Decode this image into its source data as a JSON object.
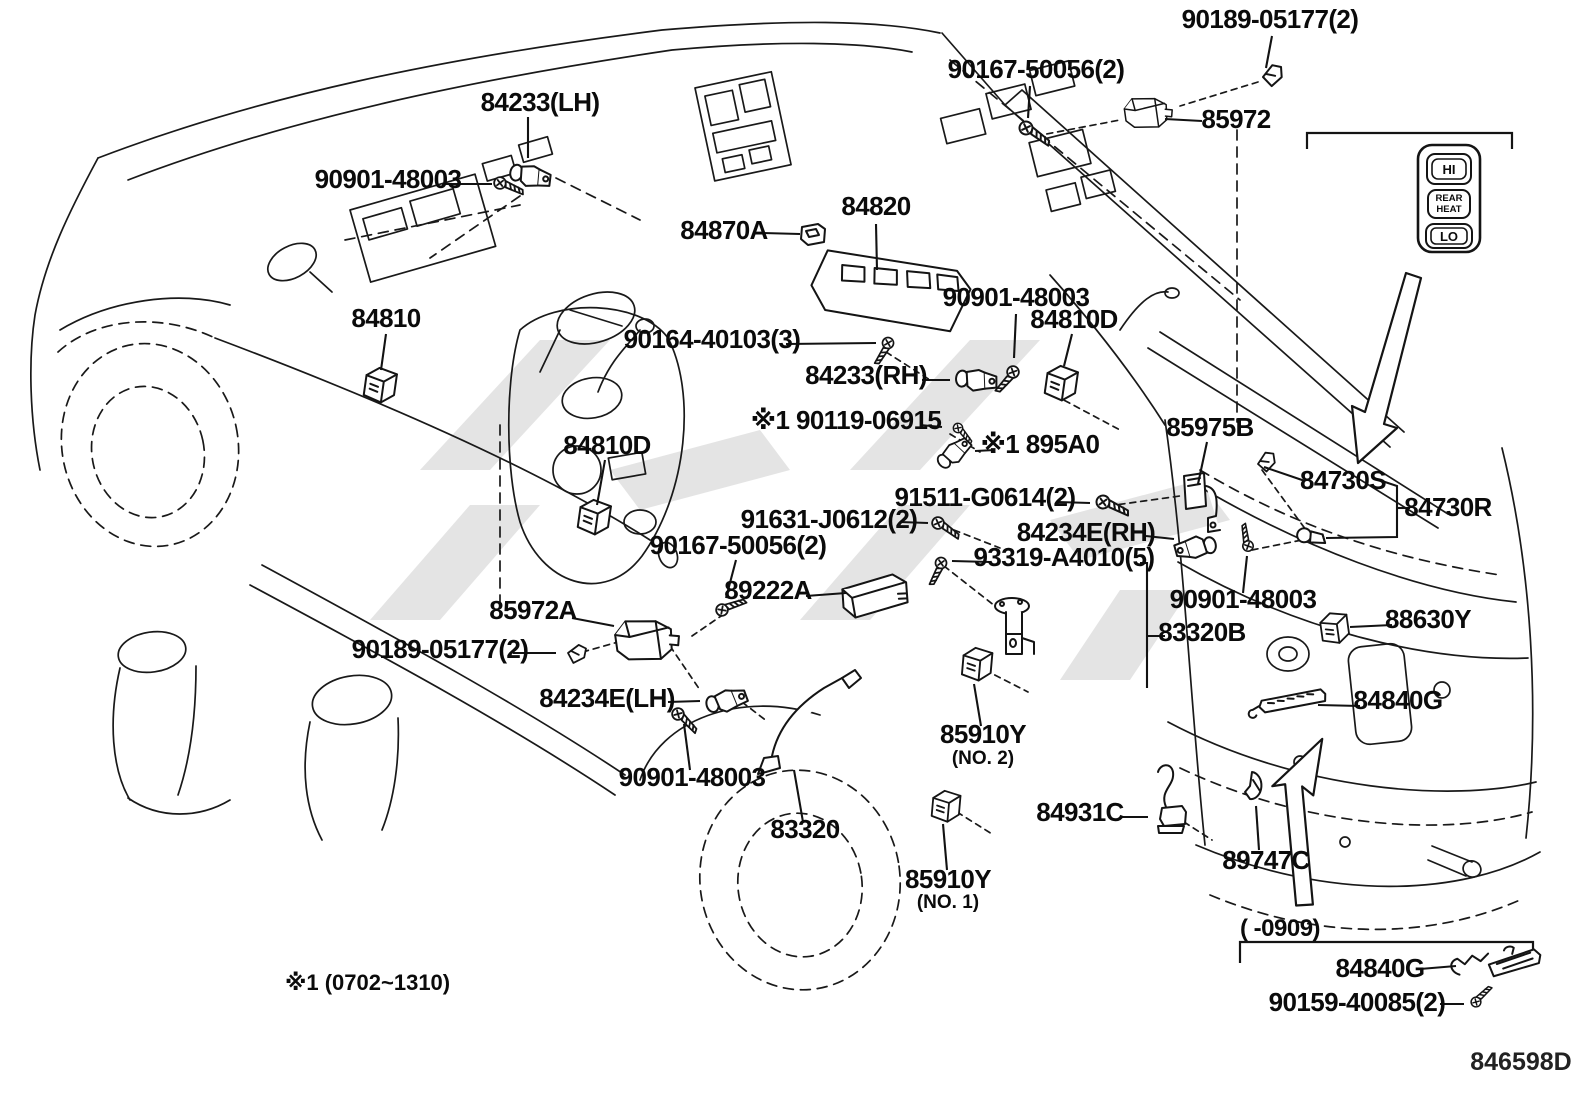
{
  "diagram_code": "846598D",
  "footnote": "※1 (0702~1310)",
  "bottom_inset": {
    "caption": "(    -0909)"
  },
  "inset_switch": {
    "hi": "HI",
    "rear": "REAR",
    "heat": "HEAT",
    "lo": "LO"
  },
  "colors": {
    "ink": "#141414",
    "paper": "#ffffff",
    "watermark": "#c9c9c9"
  },
  "labels": [
    {
      "text": "90189-05177(2)",
      "x": 1270,
      "y": 28,
      "leader": [
        [
          1272,
          36
        ],
        [
          1266,
          68
        ]
      ]
    },
    {
      "text": "90167-50056(2)",
      "x": 1036,
      "y": 78,
      "leader": [
        [
          1030,
          86
        ],
        [
          1028,
          118
        ]
      ]
    },
    {
      "text": "85972",
      "x": 1236,
      "y": 128,
      "leader": [
        [
          1202,
          121
        ],
        [
          1165,
          119
        ]
      ]
    },
    {
      "text": "84233(LH)",
      "x": 540,
      "y": 111,
      "leader": [
        [
          528,
          117
        ],
        [
          528,
          158
        ]
      ]
    },
    {
      "text": "90901-48003",
      "x": 388,
      "y": 188,
      "leader": [
        [
          442,
          184
        ],
        [
          492,
          184
        ]
      ]
    },
    {
      "text": "84870A",
      "x": 724,
      "y": 239,
      "leader": [
        [
          763,
          233
        ],
        [
          800,
          234
        ]
      ]
    },
    {
      "text": "84820",
      "x": 876,
      "y": 215,
      "leader": [
        [
          876,
          224
        ],
        [
          877,
          270
        ]
      ]
    },
    {
      "text": "90164-40103(3)",
      "x": 712,
      "y": 348,
      "leader": [
        [
          786,
          344
        ],
        [
          876,
          343
        ]
      ]
    },
    {
      "text": "84810",
      "x": 386,
      "y": 327,
      "leader": [
        [
          386,
          334
        ],
        [
          381,
          370
        ]
      ]
    },
    {
      "text": "84233(RH)",
      "x": 866,
      "y": 384,
      "leader": [
        [
          922,
          380
        ],
        [
          950,
          380
        ]
      ]
    },
    {
      "text": "90901-48003",
      "x": 1016,
      "y": 306,
      "leader": [
        [
          1016,
          314
        ],
        [
          1014,
          358
        ]
      ]
    },
    {
      "text": "84810D",
      "x": 1074,
      "y": 328,
      "leader": [
        [
          1072,
          334
        ],
        [
          1064,
          366
        ]
      ]
    },
    {
      "text": "※1 90119-06915",
      "x": 846,
      "y": 429,
      "leader": [
        [
          920,
          425
        ],
        [
          942,
          427
        ]
      ]
    },
    {
      "text": "※1 895A0",
      "x": 1040,
      "y": 453,
      "leader": [
        [
          995,
          450
        ],
        [
          975,
          451
        ]
      ]
    },
    {
      "text": "91511-G0614(2)",
      "x": 985,
      "y": 506,
      "leader": [
        [
          1058,
          502
        ],
        [
          1090,
          503
        ]
      ]
    },
    {
      "text": "91631-J0612(2)",
      "x": 829,
      "y": 528,
      "leader": [
        [
          900,
          522
        ],
        [
          928,
          523
        ]
      ]
    },
    {
      "text": "84234E(RH)",
      "x": 1086,
      "y": 541,
      "leader": [
        [
          1146,
          536
        ],
        [
          1174,
          539
        ]
      ]
    },
    {
      "text": "93319-A4010(5)",
      "x": 1064,
      "y": 566,
      "leader": [
        [
          990,
          562
        ],
        [
          952,
          561
        ]
      ],
      "leader2": [
        [
          1140,
          563
        ],
        [
          1147,
          563
        ],
        [
          1147,
          688
        ]
      ]
    },
    {
      "text": "83320B",
      "x": 1202,
      "y": 641,
      "leader": [
        [
          1165,
          636
        ],
        [
          1148,
          636
        ]
      ]
    },
    {
      "text": "85975B",
      "x": 1210,
      "y": 436,
      "leader": [
        [
          1207,
          442
        ],
        [
          1198,
          484
        ]
      ]
    },
    {
      "text": "84730S",
      "x": 1343,
      "y": 489,
      "leader": [
        [
          1305,
          481
        ],
        [
          1264,
          467
        ]
      ],
      "leader2": [
        [
          1382,
          481
        ],
        [
          1397,
          486
        ],
        [
          1397,
          537
        ],
        [
          1326,
          538
        ]
      ]
    },
    {
      "text": "84730R",
      "x": 1448,
      "y": 516,
      "leader": [
        [
          1410,
          508
        ],
        [
          1397,
          508
        ]
      ]
    },
    {
      "text": "90901-48003",
      "x": 1243,
      "y": 608,
      "leader": [
        [
          1243,
          593
        ],
        [
          1247,
          556
        ]
      ]
    },
    {
      "text": "88630Y",
      "x": 1428,
      "y": 628,
      "leader": [
        [
          1392,
          625
        ],
        [
          1350,
          627
        ]
      ]
    },
    {
      "text": "84840G",
      "x": 1398,
      "y": 709,
      "leader": [
        [
          1360,
          706
        ],
        [
          1318,
          705
        ]
      ]
    },
    {
      "text": "85910Y",
      "x": 983,
      "y": 743,
      "sub": "(NO. 2)",
      "suby": 764,
      "leader": [
        [
          981,
          726
        ],
        [
          974,
          684
        ]
      ]
    },
    {
      "text": "84931C",
      "x": 1080,
      "y": 821,
      "leader": [
        [
          1120,
          817
        ],
        [
          1148,
          817
        ]
      ]
    },
    {
      "text": "89747C",
      "x": 1266,
      "y": 869,
      "leader": [
        [
          1259,
          850
        ],
        [
          1256,
          806
        ]
      ]
    },
    {
      "text": "85910Y",
      "x": 948,
      "y": 888,
      "sub": "(NO. 1)",
      "suby": 908,
      "leader": [
        [
          947,
          870
        ],
        [
          943,
          824
        ]
      ]
    },
    {
      "text": "83320",
      "x": 805,
      "y": 838,
      "leader": [
        [
          803,
          822
        ],
        [
          794,
          770
        ]
      ]
    },
    {
      "text": "90901-48003",
      "x": 692,
      "y": 786,
      "leader": [
        [
          690,
          770
        ],
        [
          684,
          724
        ]
      ]
    },
    {
      "text": "84234E(LH)",
      "x": 607,
      "y": 707,
      "leader": [
        [
          668,
          702
        ],
        [
          700,
          701
        ]
      ]
    },
    {
      "text": "90189-05177(2)",
      "x": 440,
      "y": 658,
      "leader": [
        [
          513,
          653
        ],
        [
          556,
          653
        ]
      ]
    },
    {
      "text": "90167-50056(2)",
      "x": 738,
      "y": 554,
      "leader": [
        [
          736,
          560
        ],
        [
          726,
          598
        ]
      ]
    },
    {
      "text": "85972A",
      "x": 533,
      "y": 619,
      "leader": [
        [
          572,
          618
        ],
        [
          614,
          626
        ]
      ]
    },
    {
      "text": "89222A",
      "x": 768,
      "y": 599,
      "leader": [
        [
          806,
          596
        ],
        [
          846,
          593
        ]
      ]
    },
    {
      "text": "84810D",
      "x": 607,
      "y": 454,
      "leader": [
        [
          605,
          460
        ],
        [
          597,
          505
        ]
      ]
    },
    {
      "text": "84840G",
      "x": 1380,
      "y": 977,
      "leader": [
        [
          1420,
          969
        ],
        [
          1456,
          966
        ]
      ]
    },
    {
      "text": "90159-40085(2)",
      "x": 1357,
      "y": 1011,
      "leader": [
        [
          1440,
          1004
        ],
        [
          1464,
          1004
        ]
      ]
    }
  ],
  "parts": [
    {
      "type": "clip",
      "x": 1263,
      "y": 77,
      "rot": -15
    },
    {
      "type": "screw",
      "x": 1026,
      "y": 128,
      "rot": 20
    },
    {
      "type": "actuator",
      "x": 1146,
      "y": 112,
      "rot": -8,
      "scale": 0.75
    },
    {
      "type": "sensor",
      "x": 532,
      "y": 176,
      "rot": 12
    },
    {
      "type": "screw",
      "x": 500,
      "y": 183,
      "rot": 8,
      "scale": 0.9
    },
    {
      "type": "sswitch",
      "x": 812,
      "y": 235,
      "rot": 0
    },
    {
      "type": "mswitch",
      "x": 890,
      "y": 287,
      "rot": 16
    },
    {
      "type": "screw",
      "x": 888,
      "y": 343,
      "rot": 105,
      "scale": 0.85
    },
    {
      "type": "relay",
      "x": 379,
      "y": 387,
      "rot": 8
    },
    {
      "type": "sensor",
      "x": 978,
      "y": 380,
      "rot": 5
    },
    {
      "type": "screw",
      "x": 1013,
      "y": 372,
      "rot": 115,
      "scale": 0.9
    },
    {
      "type": "relay",
      "x": 1060,
      "y": 385,
      "rot": 8
    },
    {
      "type": "screw",
      "x": 958,
      "y": 428,
      "rot": 35,
      "scale": 0.72
    },
    {
      "type": "sensor",
      "x": 955,
      "y": 452,
      "rot": -40,
      "scale": 0.9
    },
    {
      "type": "screw",
      "x": 1103,
      "y": 502,
      "rot": 10
    },
    {
      "type": "screw",
      "x": 938,
      "y": 523,
      "rot": 20,
      "scale": 0.9
    },
    {
      "type": "sensor",
      "x": 1194,
      "y": 548,
      "rot": 170
    },
    {
      "type": "screw",
      "x": 941,
      "y": 563,
      "rot": 100,
      "scale": 0.85
    },
    {
      "type": "sender",
      "x": 1012,
      "y": 640,
      "rot": 0
    },
    {
      "type": "relayb",
      "x": 1196,
      "y": 498,
      "rot": 0
    },
    {
      "type": "clip",
      "x": 1258,
      "y": 464,
      "rot": -20,
      "scale": 0.9
    },
    {
      "type": "bulb",
      "x": 1314,
      "y": 537,
      "rot": 10
    },
    {
      "type": "screw",
      "x": 1248,
      "y": 546,
      "rot": -115,
      "scale": 0.8
    },
    {
      "type": "relay",
      "x": 1334,
      "y": 630,
      "rot": -8,
      "scale": 0.9
    },
    {
      "type": "busbar",
      "x": 1292,
      "y": 702,
      "rot": -7
    },
    {
      "type": "relay",
      "x": 976,
      "y": 666,
      "rot": 5,
      "scale": 0.95
    },
    {
      "type": "camera",
      "x": 1172,
      "y": 816,
      "rot": 0
    },
    {
      "type": "grommet",
      "x": 1256,
      "y": 787,
      "rot": 0
    },
    {
      "type": "relay",
      "x": 945,
      "y": 808,
      "rot": 5,
      "scale": 0.9
    },
    {
      "type": "rod",
      "x": 800,
      "y": 718,
      "rot": 0
    },
    {
      "type": "screw",
      "x": 678,
      "y": 714,
      "rot": 30,
      "scale": 0.9
    },
    {
      "type": "sensor",
      "x": 728,
      "y": 700,
      "rot": -15
    },
    {
      "type": "clip",
      "x": 568,
      "y": 653,
      "rot": 0,
      "scale": 0.9
    },
    {
      "type": "screw",
      "x": 722,
      "y": 610,
      "rot": -35,
      "scale": 0.9
    },
    {
      "type": "actuator",
      "x": 644,
      "y": 639,
      "rot": -8
    },
    {
      "type": "ecu",
      "x": 874,
      "y": 596,
      "rot": -10
    },
    {
      "type": "relay",
      "x": 593,
      "y": 519,
      "rot": 8
    },
    {
      "type": "hingep",
      "x": 1497,
      "y": 966,
      "rot": -4
    },
    {
      "type": "screw",
      "x": 1476,
      "y": 1002,
      "rot": -60,
      "scale": 0.75
    }
  ]
}
